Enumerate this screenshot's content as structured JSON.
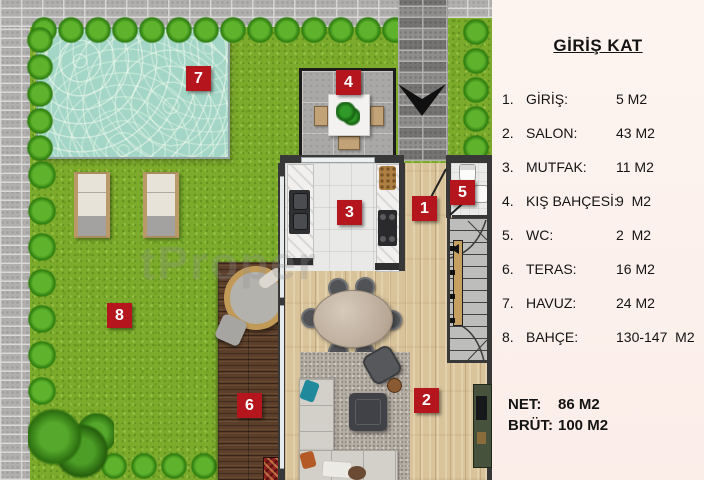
{
  "plan": {
    "badges": [
      "1",
      "2",
      "3",
      "4",
      "5",
      "6",
      "7",
      "8"
    ],
    "watermark": "tProper"
  },
  "legend": {
    "title": "GİRİŞ KAT",
    "items": [
      {
        "num": "1.",
        "label": "GİRİŞ:",
        "value": "5 M2"
      },
      {
        "num": "2.",
        "label": "SALON:",
        "value": "43 M2"
      },
      {
        "num": "3.",
        "label": "MUTFAK:",
        "value": "11 M2"
      },
      {
        "num": "4.",
        "label": "KIŞ BAHÇESİ:",
        "value": "9  M2"
      },
      {
        "num": "5.",
        "label": "WC:",
        "value": "2  M2"
      },
      {
        "num": "6.",
        "label": "TERAS:",
        "value": "16 M2"
      },
      {
        "num": "7.",
        "label": "HAVUZ:",
        "value": "24 M2"
      },
      {
        "num": "8.",
        "label": "BAHÇE:",
        "value": "130-147  M2"
      }
    ],
    "totals": {
      "net_label": "NET:",
      "net_value": "86 M2",
      "brut_label": "BRÜT:",
      "brut_value": "100 M2"
    }
  },
  "colors": {
    "badge_red": "#b5151d",
    "grass_green": "#7cab2b",
    "pool_water": "#a3d6c7",
    "deck_brown": "#5c3f2a",
    "legend_bg": "#fcf0ec"
  }
}
